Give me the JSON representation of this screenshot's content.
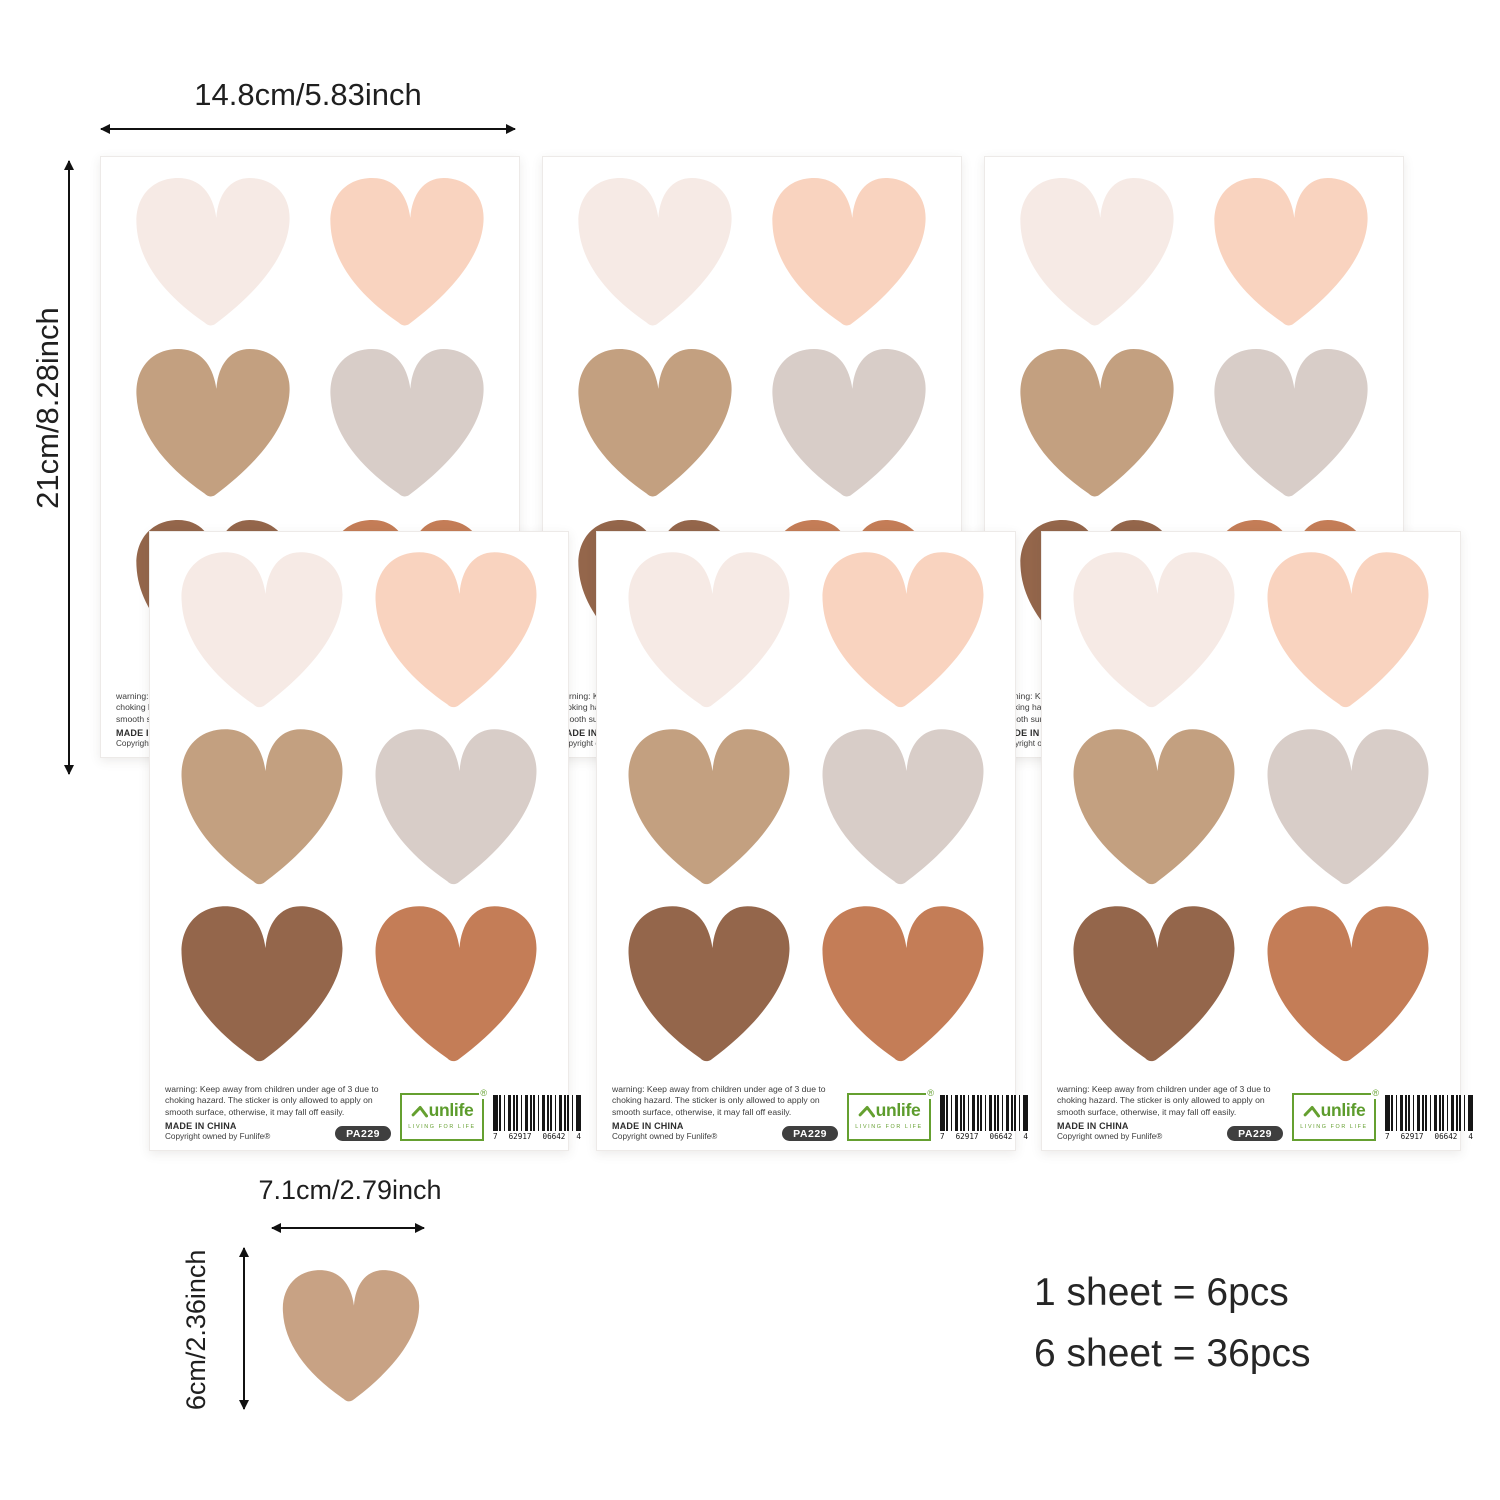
{
  "annotations": {
    "sheet_width": "14.8cm/5.83inch",
    "sheet_height": "21cm/8.28inch",
    "heart_width": "7.1cm/2.79inch",
    "heart_height": "6cm/2.36inch"
  },
  "sheet": {
    "warning": "warning: Keep away from children under age of 3 due to choking hazard. The sticker is only allowed to apply on smooth surface, otherwise, it may fall off easily.",
    "made_in": "MADE IN CHINA",
    "copyright": "Copyright owned by Funlife®",
    "product_code": "PA229",
    "logo": {
      "name": "unlife",
      "reg": "®",
      "tagline": "LIVING FOR LIFE",
      "color": "#65a030"
    },
    "barcode": {
      "d1": "7",
      "d2": "62917",
      "d3": "06642",
      "d4": "4"
    },
    "heart_colors": [
      "#f6eae5",
      "#f9d3bf",
      "#c3a080",
      "#d8cdc8",
      "#94664b",
      "#c47d57"
    ]
  },
  "single_heart": {
    "color": "#c8a284"
  },
  "pack_info": {
    "line1": "1 sheet = 6pcs",
    "line2": "6 sheet = 36pcs"
  }
}
